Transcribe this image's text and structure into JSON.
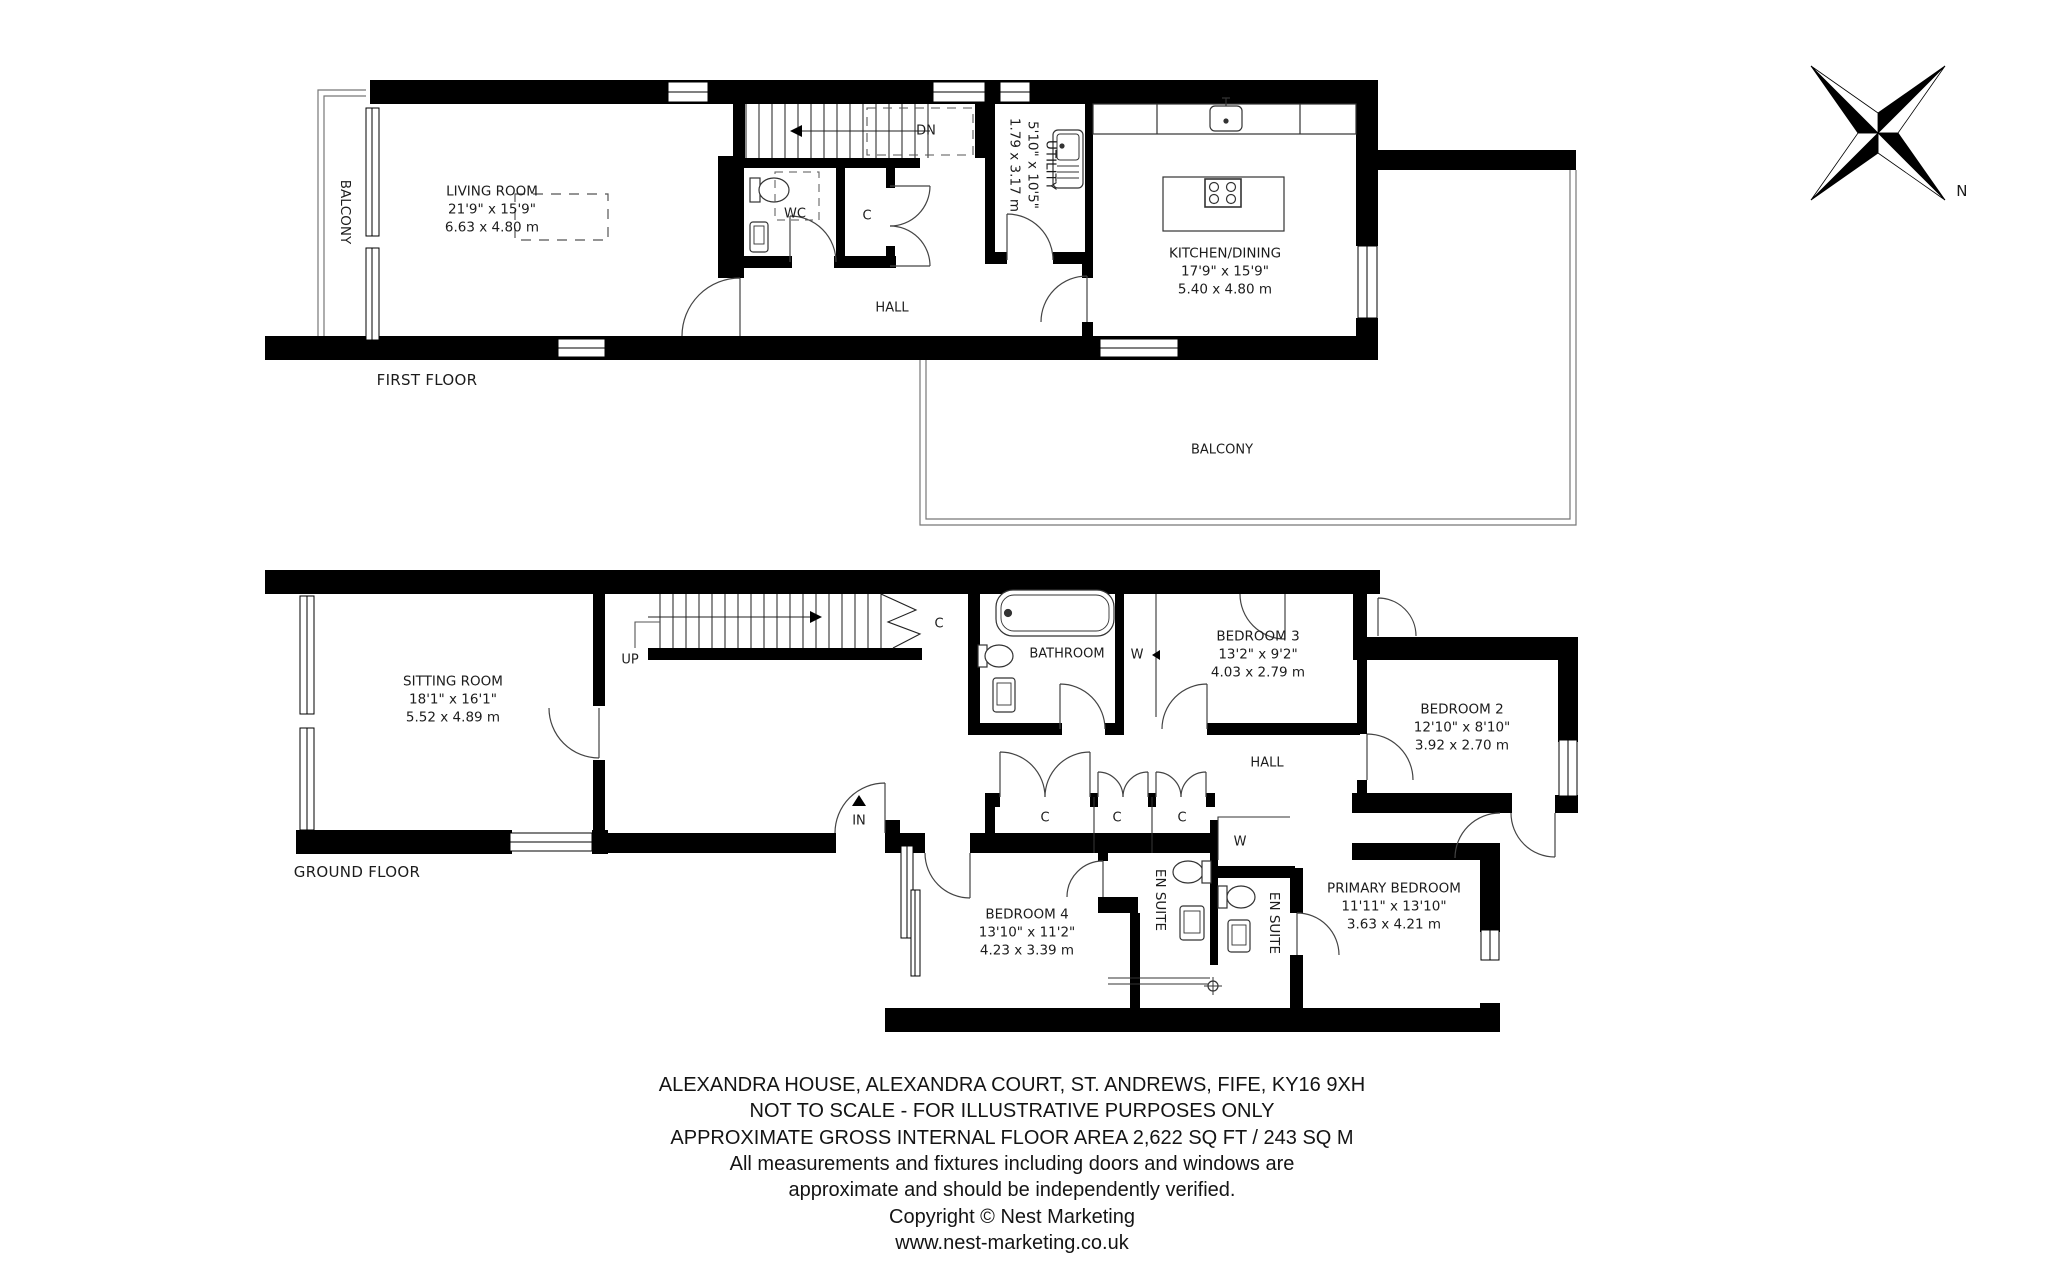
{
  "first_floor": {
    "floor_label": "FIRST FLOOR",
    "balcony_side": "BALCONY",
    "balcony_rear": "BALCONY",
    "hall": "HALL",
    "dn": "DN",
    "wc": "WC",
    "cupboard": "C",
    "living_room": {
      "name": "LIVING ROOM",
      "imperial": "21'9\" x 15'9\"",
      "metric": "6.63 x 4.80 m"
    },
    "kitchen_dining": {
      "name": "KITCHEN/DINING",
      "imperial": "17'9\" x 15'9\"",
      "metric": "5.40 x 4.80 m"
    },
    "utility": {
      "name": "UTILITY",
      "imperial": "5'10\" x 10'5\"",
      "metric": "1.79 x 3.17 m"
    }
  },
  "ground_floor": {
    "floor_label": "GROUND FLOOR",
    "hall": "HALL",
    "up": "UP",
    "in": "IN",
    "bathroom": "BATHROOM",
    "wardrobe_1": "W",
    "wardrobe_2": "W",
    "cupboards": [
      "C",
      "C",
      "C",
      "C"
    ],
    "en_suite_1": "EN SUITE",
    "en_suite_2": "EN SUITE",
    "sitting_room": {
      "name": "SITTING ROOM",
      "imperial": "18'1\" x 16'1\"",
      "metric": "5.52 x 4.89 m"
    },
    "bedroom_2": {
      "name": "BEDROOM 2",
      "imperial": "12'10\" x 8'10\"",
      "metric": "3.92 x 2.70 m"
    },
    "bedroom_3": {
      "name": "BEDROOM 3",
      "imperial": "13'2\" x 9'2\"",
      "metric": "4.03 x 2.79 m"
    },
    "bedroom_4": {
      "name": "BEDROOM 4",
      "imperial": "13'10\" x 11'2\"",
      "metric": "4.23 x 3.39 m"
    },
    "primary_bedroom": {
      "name": "PRIMARY BEDROOM",
      "imperial": "11'11\" x 13'10\"",
      "metric": "3.63 x 4.21 m"
    }
  },
  "compass": {
    "north": "N"
  },
  "title_block": {
    "lines": [
      "ALEXANDRA HOUSE, ALEXANDRA COURT, ST. ANDREWS, FIFE, KY16 9XH",
      "NOT TO SCALE - FOR ILLUSTRATIVE PURPOSES ONLY",
      "APPROXIMATE GROSS INTERNAL FLOOR AREA 2,622 SQ FT / 243 SQ M",
      "All measurements and fixtures including doors and windows are",
      "approximate and should be independently verified.",
      "Copyright © Nest Marketing",
      "www.nest-marketing.co.uk"
    ]
  },
  "colors": {
    "wall": "#000000",
    "line": "#3a3a3a",
    "background": "#ffffff"
  }
}
